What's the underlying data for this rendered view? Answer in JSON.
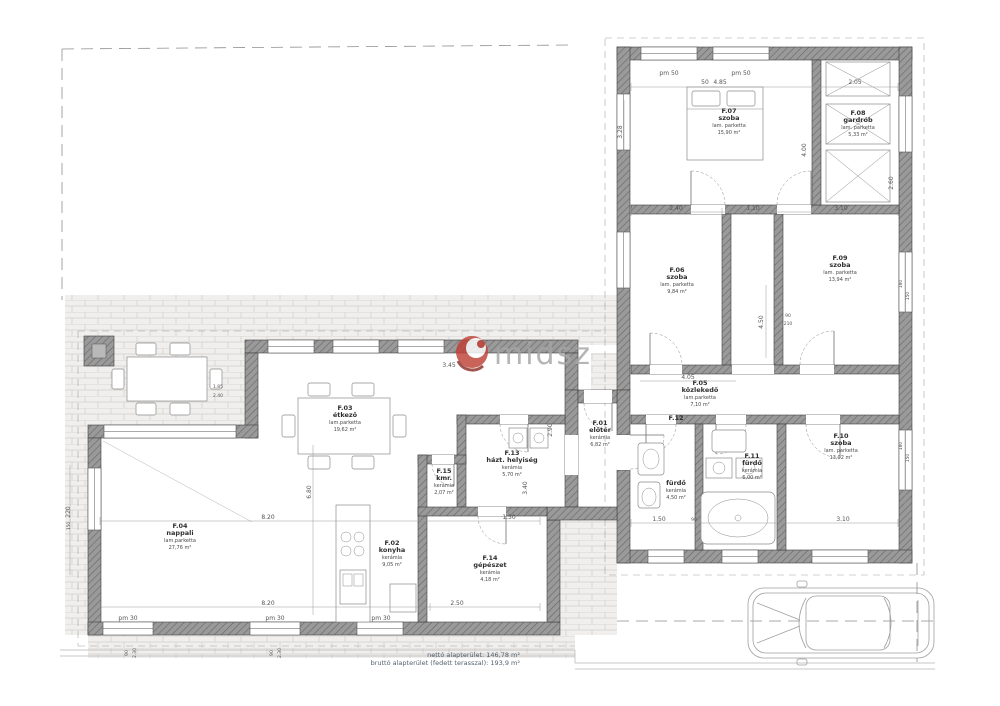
{
  "watermark": {
    "text": "midsz"
  },
  "summary": {
    "line1": "nettó alapterület: 146,78 m²",
    "line2": "bruttó alapterület (fedett terasszal): 193,9 m²"
  },
  "rooms": [
    {
      "id": "F.01",
      "name": "előtér",
      "floor": "kerámia",
      "area": "6,82 m²"
    },
    {
      "id": "F.02",
      "name": "konyha",
      "floor": "kerámia",
      "area": "9,05 m²"
    },
    {
      "id": "F.03",
      "name": "étkező",
      "floor": "lam.parketta",
      "area": "19,62 m²"
    },
    {
      "id": "F.04",
      "name": "nappali",
      "floor": "lam.parketta",
      "area": "27,76 m²"
    },
    {
      "id": "F.05",
      "name": "közlekedő",
      "floor": "lam.parketta",
      "area": "7,10 m²"
    },
    {
      "id": "F.06",
      "name": "szoba",
      "floor": "lam. parketta",
      "area": "9,84 m²"
    },
    {
      "id": "F.07",
      "name": "szoba",
      "floor": "lam. parketta",
      "area": "15,90 m²"
    },
    {
      "id": "F.08",
      "name": "gardrób",
      "floor": "lam. parketta",
      "area": "5,33 m²"
    },
    {
      "id": "F.09",
      "name": "szoba",
      "floor": "lam. parketta",
      "area": "13,94 m²"
    },
    {
      "id": "F.10",
      "name": "szoba",
      "floor": "lam. parketta",
      "area": "13,02 m²"
    },
    {
      "id": "F.11",
      "name": "fürdő",
      "floor": "kerámia",
      "area": "6,00 m²"
    },
    {
      "id": "F.12",
      "name": "fürdő",
      "floor": "kerámia",
      "area": "4,50 m²"
    },
    {
      "id": "F.13",
      "name": "házt. helyiség",
      "floor": "kerámia",
      "area": "5,70 m²"
    },
    {
      "id": "F.14",
      "name": "gépészet",
      "floor": "kerámia",
      "area": "4,18 m²"
    },
    {
      "id": "F.15",
      "name": "kmr.",
      "floor": "kerámia",
      "area": "2,07 m²"
    }
  ],
  "dims": [
    {
      "t": "4.85"
    },
    {
      "t": "2.05"
    },
    {
      "t": "50"
    },
    {
      "t": "pm 50"
    },
    {
      "t": "pm 50"
    },
    {
      "t": "2.40"
    },
    {
      "t": "1.10"
    },
    {
      "t": "3.10"
    },
    {
      "t": "3.28"
    },
    {
      "t": "4.00"
    },
    {
      "t": "2.60"
    },
    {
      "t": "4.50"
    },
    {
      "t": "4.05"
    },
    {
      "t": "90"
    },
    {
      "t": "210"
    },
    {
      "t": "1.50"
    },
    {
      "t": "90"
    },
    {
      "t": "3.10"
    },
    {
      "t": "2.90"
    },
    {
      "t": "3.40"
    },
    {
      "t": "3.45"
    },
    {
      "t": "6.80"
    },
    {
      "t": "8.20"
    },
    {
      "t": "1.50"
    },
    {
      "t": "8.20"
    },
    {
      "t": "2.50"
    },
    {
      "t": "pm 30"
    },
    {
      "t": "pm 30"
    },
    {
      "t": "pm 30"
    },
    {
      "t": "220"
    },
    {
      "t": "150"
    },
    {
      "t": "180"
    },
    {
      "t": "150"
    },
    {
      "t": "180"
    },
    {
      "t": "150"
    },
    {
      "t": "1.85"
    },
    {
      "t": "2.40"
    },
    {
      "t": "90"
    },
    {
      "t": "2.30"
    },
    {
      "t": "90"
    },
    {
      "t": "2.30"
    }
  ]
}
